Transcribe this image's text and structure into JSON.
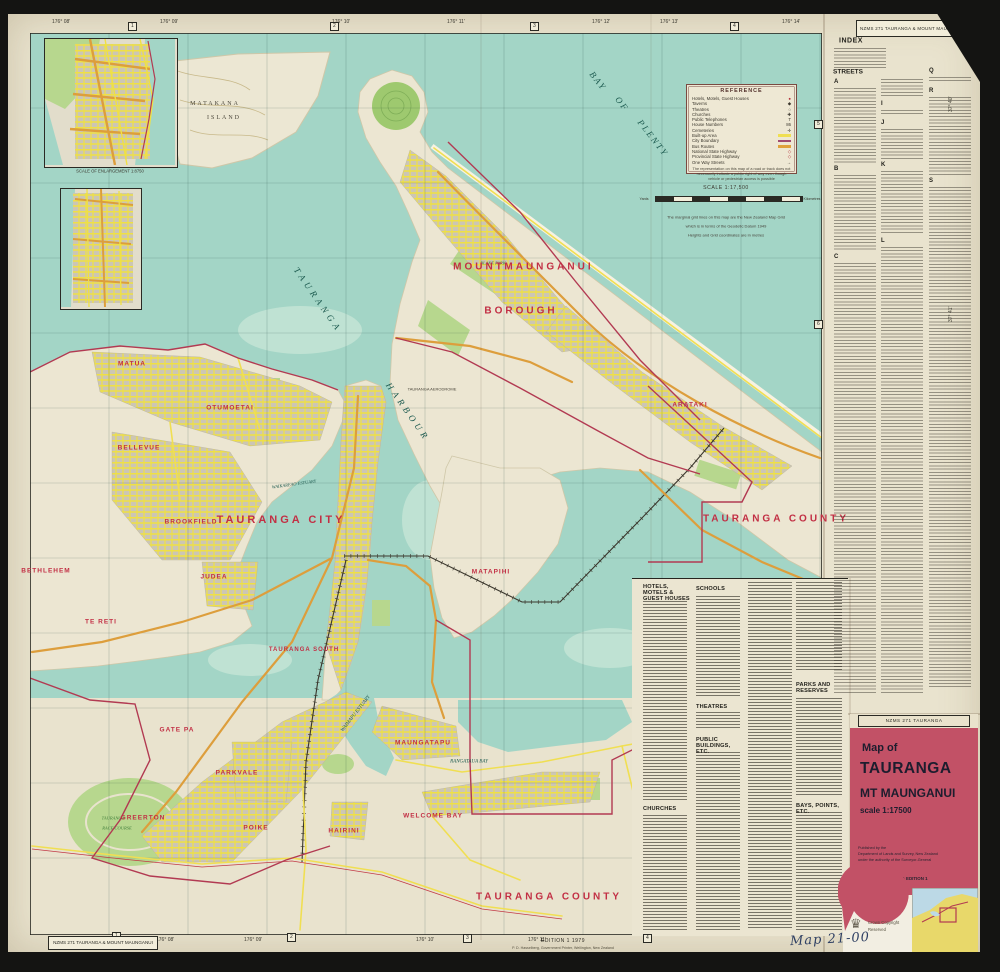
{
  "sheet": {
    "top_right_label": "NZMS 271 TAURANGA & MOUNT MAUNGANUI",
    "bottom_left_label": "NZMS 271 TAURANGA & MOUNT MAUNGANUI",
    "edition_line": "EDITION 1 1979",
    "imprint_line": "P. D. Hasselberg, Government Printer, Wellington, New Zealand",
    "handwriting": "Map 21-00",
    "copyright_line1": "Crown Copyright",
    "copyright_line2": "Reserved"
  },
  "legend": {
    "title": "REFERENCE",
    "rows": [
      {
        "label": "Hotels, Motels, Guest Houses",
        "symbol": "●"
      },
      {
        "label": "Taverns",
        "symbol": "◆"
      },
      {
        "label": "Theatres",
        "symbol": "○"
      },
      {
        "label": "Churches",
        "symbol": "✚"
      },
      {
        "label": "Public Telephones",
        "symbol": "T"
      },
      {
        "label": "House Numbers",
        "symbol": "86"
      },
      {
        "label": "Cemeteries",
        "symbol": "✛"
      },
      {
        "label": "Built-up Area",
        "symbol": ""
      },
      {
        "label": "City Boundary",
        "symbol": ""
      },
      {
        "label": "Bus Routes",
        "symbol": ""
      },
      {
        "label": "National State Highway",
        "symbol": "◇"
      },
      {
        "label": "Provincial State Highway",
        "symbol": "◇"
      },
      {
        "label": "One Way Streets",
        "symbol": "→"
      }
    ],
    "note": "The representation on this map of a road or track does not necessarily indicate a public right of way even though vehicle or pedestrian access is possible"
  },
  "scale": {
    "title": "SCALE 1:17,500",
    "left_unit": "Yards",
    "right_unit": "Kilometres",
    "note1": "The marginal grid lines on this map are the New Zealand Map Grid",
    "note2": "which is in terms of the Geodetic Datum 1949",
    "note3": "Heights and Grid coordinates are in metres"
  },
  "insets": {
    "caption": "SCALE OF ENLARGEMENT 1:8750"
  },
  "index_panel": {
    "title": "INDEX",
    "streets_heading": "STREETS",
    "letters_col1": [
      "A",
      "B",
      "C"
    ],
    "letters_col2": [
      "H",
      "I",
      "J",
      "K",
      "L"
    ],
    "letters_col3": [
      "Q",
      "R",
      "S"
    ]
  },
  "directory": {
    "h1": "HOTELS, MOTELS & GUEST HOUSES",
    "h2": "SCHOOLS",
    "h3": "THEATRES",
    "h4": "PUBLIC BUILDINGS, ETC.",
    "h5": "CHURCHES",
    "h6": "PARKS AND RESERVES",
    "h7": "BAYS, POINTS, ETC."
  },
  "cover": {
    "strip": "NZMS 271 TAURANGA",
    "map_of": "Map of",
    "title": "TAURANGA",
    "subtitle": "MT MAUNGANUI",
    "scale": "scale  1:17500",
    "pub1": "Published by the",
    "pub2": "Department of Lands and Survey, New Zealand",
    "pub3": "under the authority of the Surveyor-General",
    "footer": "NZMS 271  TAURANGA  EDITION 1"
  },
  "map_labels": {
    "bop_1": "BAY",
    "bop_2": "OF",
    "bop_3": "PLENTY",
    "harbour_1": "TAURANGA",
    "harbour_2": "HARBOUR",
    "matakana_1": "MATAKANA",
    "matakana_2": "ISLAND",
    "mount": "MOUNT",
    "maunganui": "MAUNGANUI",
    "borough": "BOROUGH",
    "tauranga_city": "TAURANGA   CITY",
    "tauranga_county_e": "TAURANGA   COUNTY",
    "tauranga_county_s": "TAURANGA   COUNTY",
    "matua": "MATUA",
    "otumoetai": "OTUMOETAI",
    "bellevue": "BELLEVUE",
    "brookfield": "BROOKFIELD",
    "bethlehem": "BETHLEHEM",
    "te_reti": "TE RETI",
    "judea": "JUDEA",
    "gate_pa": "GATE PA",
    "parkvale": "PARKVALE",
    "greerton": "GREERTON",
    "poike": "POIKE",
    "hairini": "HAIRINI",
    "welcome_bay": "WELCOME BAY",
    "maungatapu": "MAUNGATAPU",
    "matapihi": "MATAPIHI",
    "arataki": "ARATAKI",
    "tauranga_south": "TAURANGA SOUTH",
    "waimapu": "WAIMAPU ESTUARY",
    "rangataua": "RANGATAUA BAY",
    "waikareao": "WAIKAREAO ESTUARY",
    "aerodrome": "TAURANGA AERODROME",
    "blake_park": "BLAKE PARK",
    "racecourse_1": "TAURANGA",
    "racecourse_2": "RACE COURSE"
  },
  "grid": {
    "top_coords": [
      "176° 08'",
      "176° 09'",
      "176° 10'",
      "176° 11'",
      "176° 12'",
      "176° 13'",
      "176° 14'"
    ],
    "bottom_coords": [
      "176° 07'",
      "176° 08'",
      "176° 09'",
      "176° 10'",
      "176° 11'"
    ],
    "right_coords": [
      "37° 40'",
      "37° 41'"
    ],
    "top_boxes": [
      "1",
      "2",
      "3",
      "4"
    ],
    "bottom_boxes": [
      "1",
      "2",
      "3",
      "4"
    ],
    "right_boxes": [
      "5",
      "6"
    ]
  },
  "colors": {
    "paper": "#e9e3ce",
    "water": "#a3d5c6",
    "urban": "#ccc6b4",
    "road_major": "#dd9e3c",
    "road_minor": "#f0df52",
    "park": "#b7d78e",
    "boundary": "#b23a52",
    "label_red": "#c22f44",
    "cover_red": "#c25166"
  }
}
